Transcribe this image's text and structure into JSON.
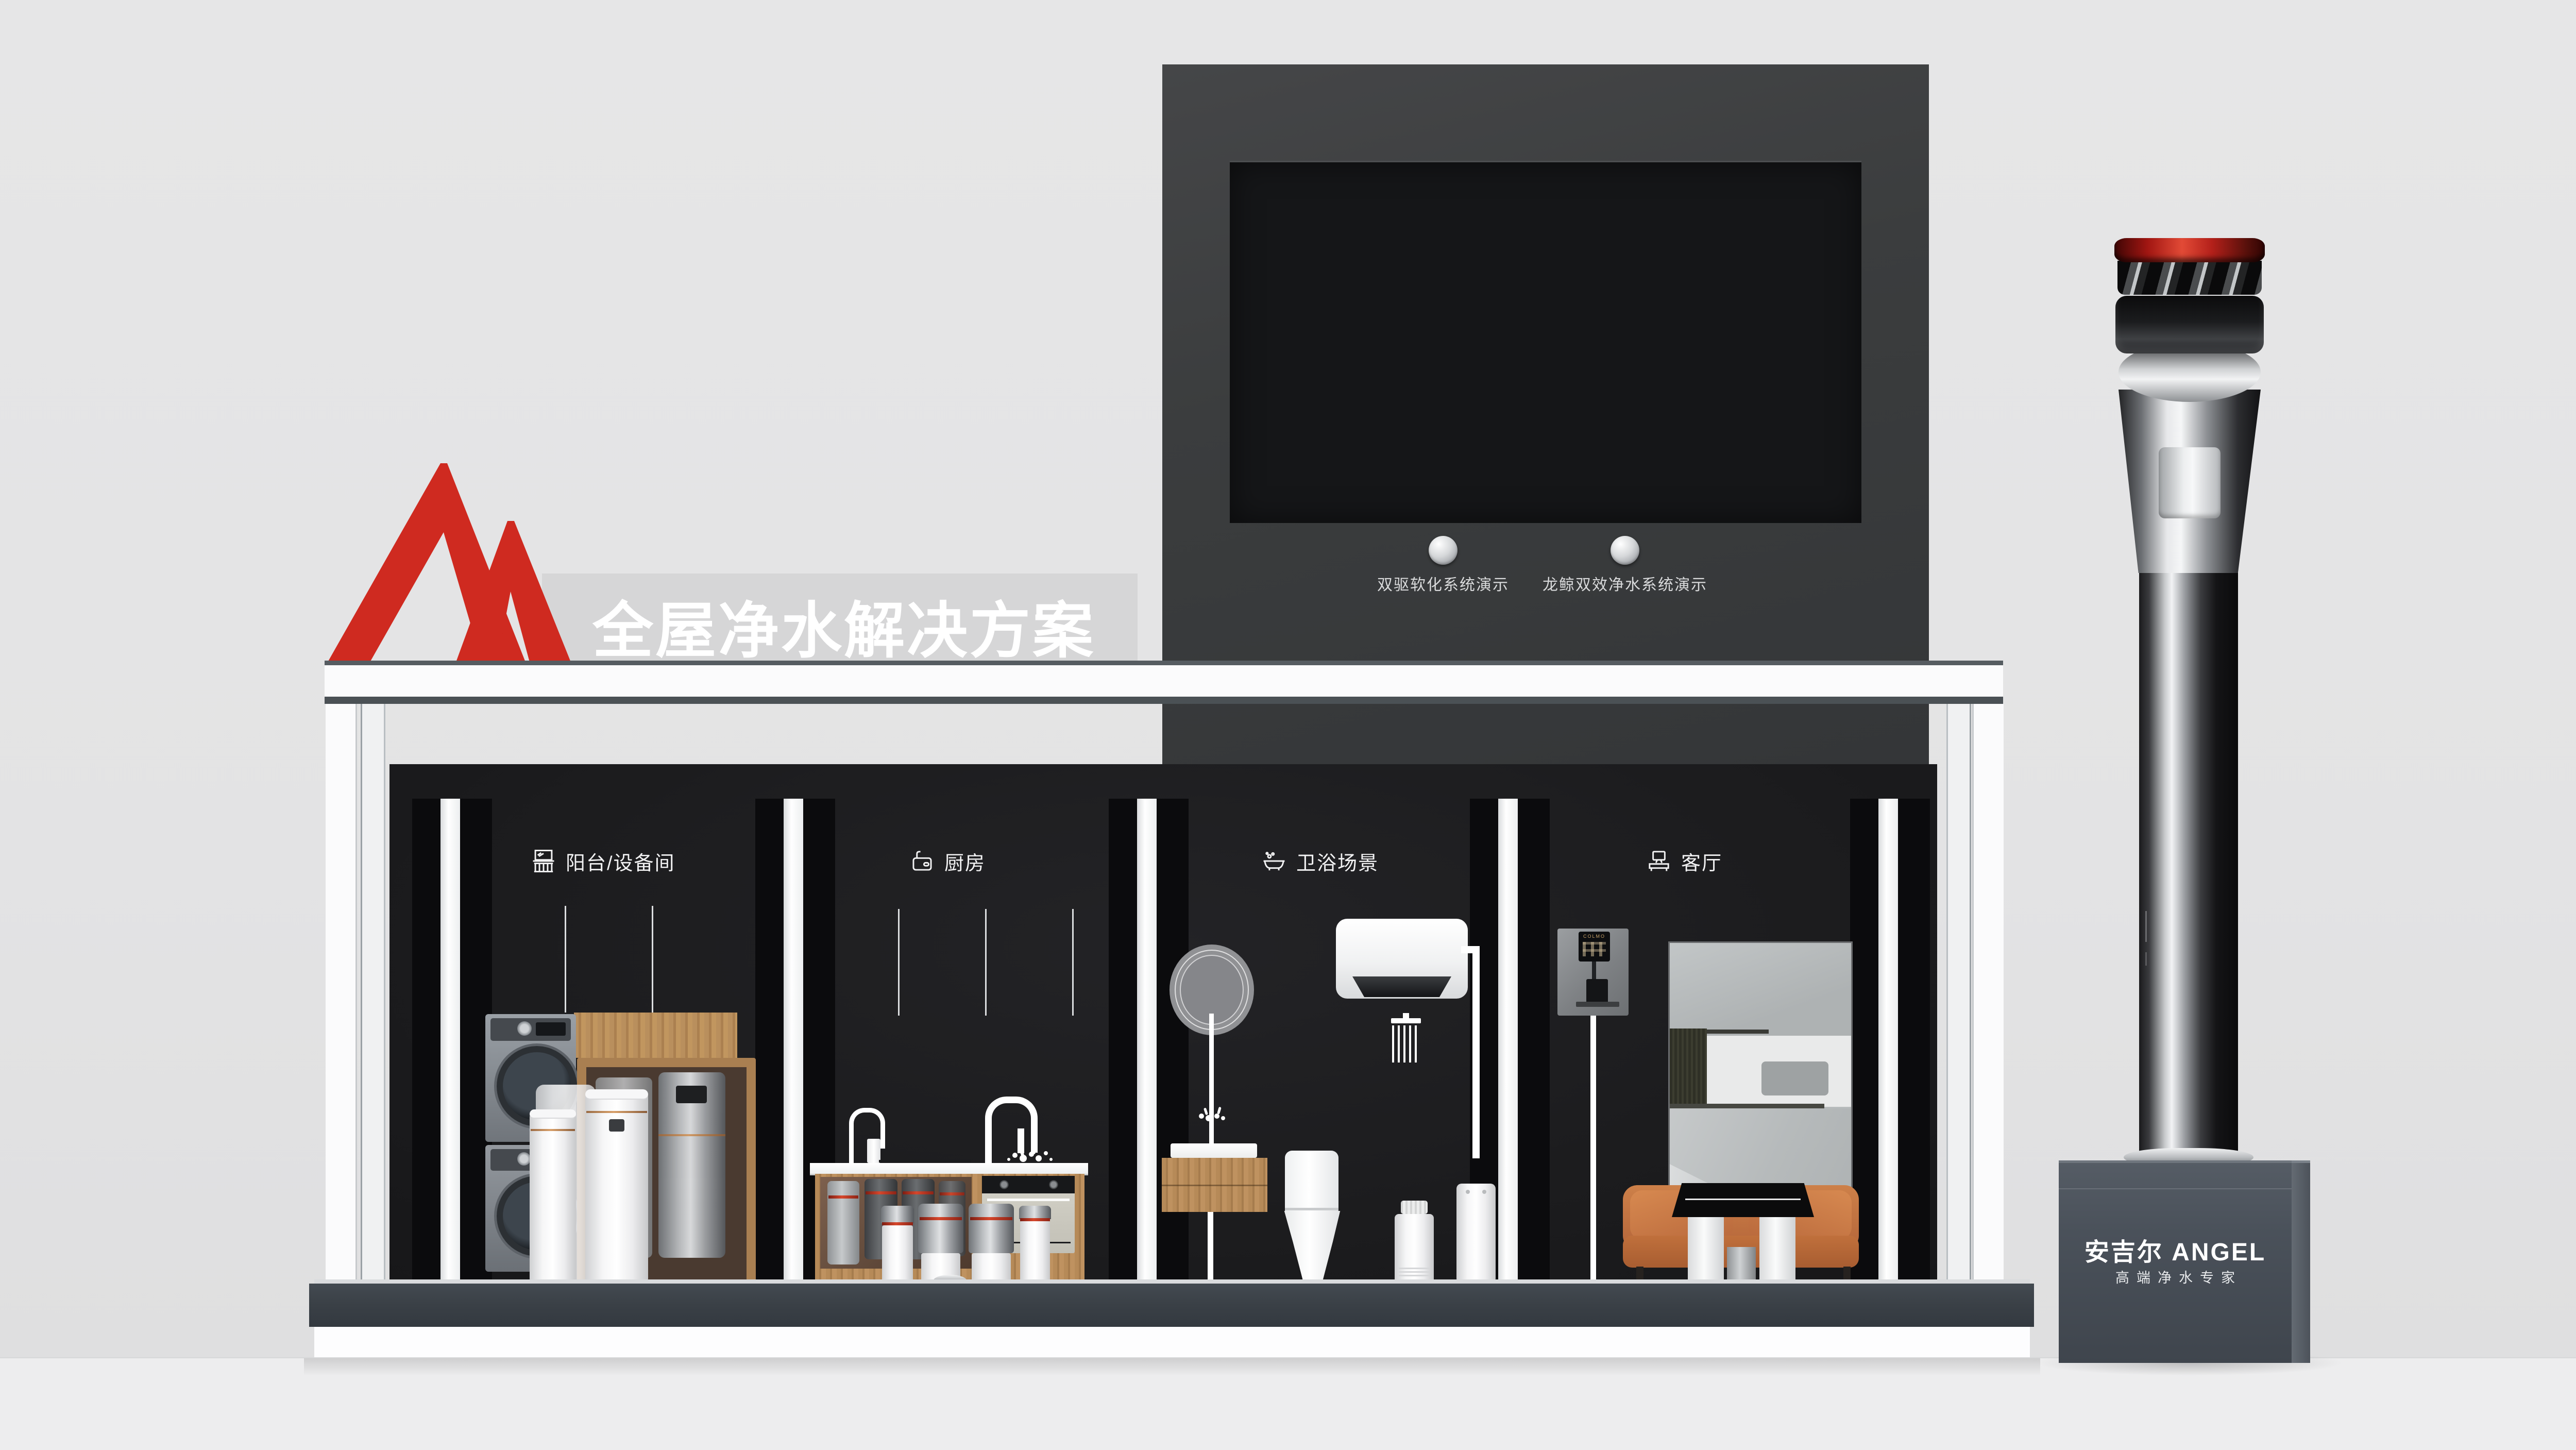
{
  "tech_panel": {
    "title": "安吉尔空间大师系列核心技术",
    "buttons": [
      {
        "label": "双驱软化系统演示"
      },
      {
        "label": "龙鲸双效净水系统演示"
      }
    ]
  },
  "banner": {
    "logo": "angel-mountain-logo",
    "text": "全屋净水解决方案"
  },
  "booth": {
    "sections": [
      {
        "icon": "balcony-icon",
        "label": "阳台/设备间"
      },
      {
        "icon": "kitchen-sink-icon",
        "label": "厨房"
      },
      {
        "icon": "bathtub-icon",
        "label": "卫浴场景"
      },
      {
        "icon": "tv-console-icon",
        "label": "客厅"
      }
    ]
  },
  "living_room": {
    "dispenser_brand": "COLMO"
  },
  "tower": {
    "brand": "安吉尔 ANGEL",
    "tagline": "高端净水专家"
  },
  "colors": {
    "accent_red": "#cf2a20",
    "panel_gray": "#3b3d3e",
    "wall_gray": "#e4e4e5",
    "booth_black": "#1d1d1f",
    "platform_slate": "#3b4147",
    "wood": "#b68a58",
    "sofa_orange": "#c0703c",
    "pedestal_slate": "#49505a"
  }
}
